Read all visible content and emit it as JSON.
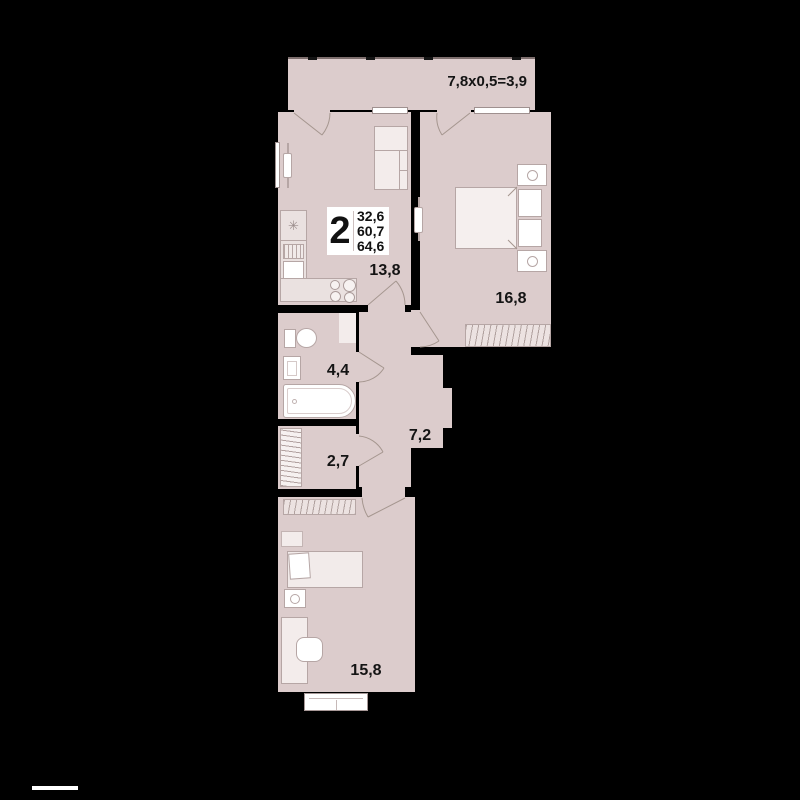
{
  "colors": {
    "background": "#000000",
    "floor": "#dccccc",
    "furniture_light": "#efe7e6",
    "furniture_white": "#ffffff",
    "outline": "#b6a6a5",
    "text": "#141414"
  },
  "balcony": {
    "dimension_label": "7,8x0,5=3,9"
  },
  "info_box": {
    "room_count": "2",
    "living_area": "32,6",
    "usable_area": "60,7",
    "total_area": "64,6"
  },
  "rooms": {
    "kitchen": {
      "area": "13,8"
    },
    "bedroom": {
      "area": "16,8"
    },
    "bathroom": {
      "area": "4,4"
    },
    "hallway": {
      "area": "7,2"
    },
    "storage": {
      "area": "2,7"
    },
    "living_room": {
      "area": "15,8"
    }
  }
}
